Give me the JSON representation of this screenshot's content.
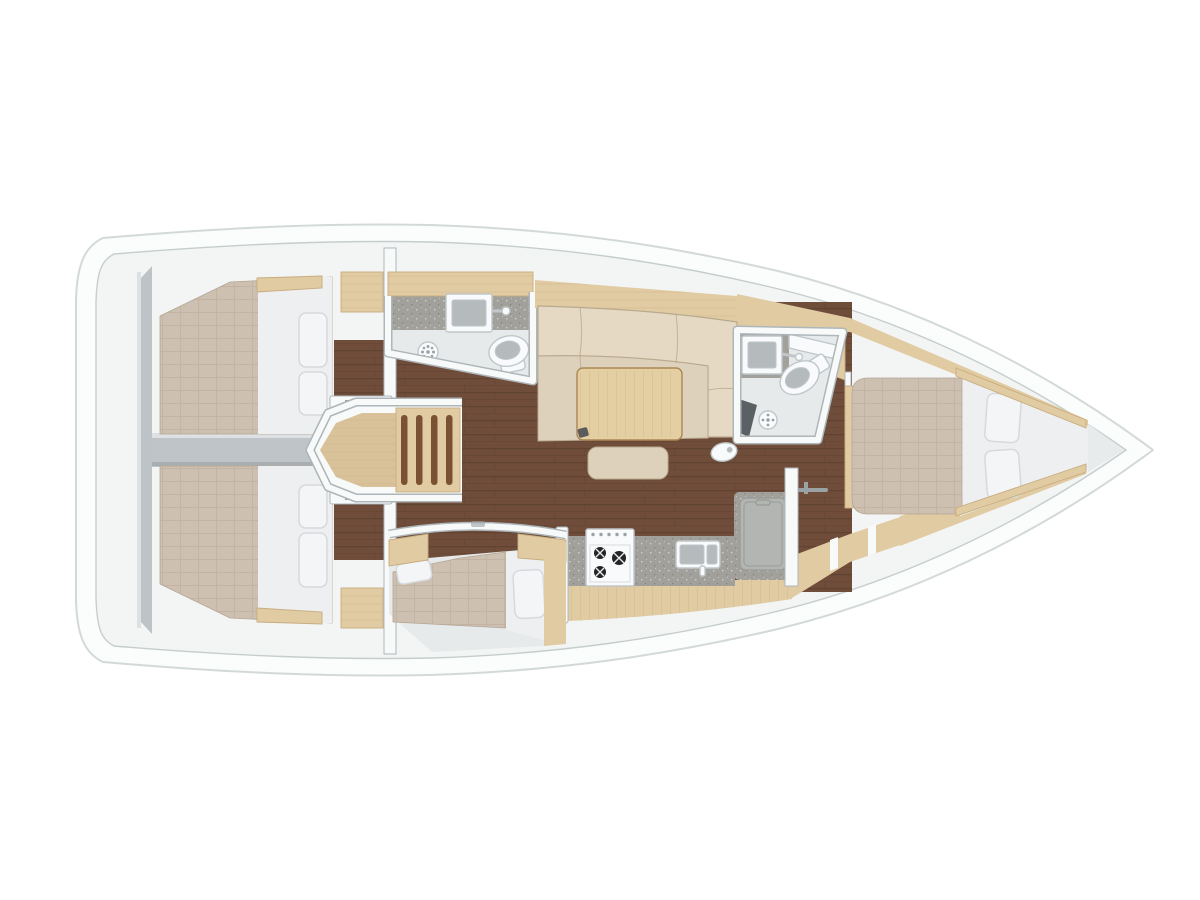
{
  "layout": {
    "title": "Sailing yacht interior layout plan — top-down view, bow to the right",
    "orientation": "bow-right",
    "regions": [
      {
        "id": "aft-cabin-port",
        "label": "aft cabin port: double berth with two pillows"
      },
      {
        "id": "aft-cabin-starboard",
        "label": "aft cabin starboard: double berth with two pillows"
      },
      {
        "id": "stern-structure",
        "label": "stern: transom bulkhead and central divider"
      },
      {
        "id": "companionway-stairs",
        "label": "companionway entry steps"
      },
      {
        "id": "aft-head-port",
        "label": "aft head: sink, toilet, shower drain"
      },
      {
        "id": "salon",
        "label": "salon: L-shaped settee, table, ottoman"
      },
      {
        "id": "galley-starboard",
        "label": "galley: 3-burner stove, double sink, top-loading fridge"
      },
      {
        "id": "forward-head",
        "label": "forward head: sink, toilet, shower drain, seat"
      },
      {
        "id": "forward-cabin",
        "label": "forward cabin: island double berth with two pillows"
      },
      {
        "id": "mid-cabin-starboard",
        "label": "mid cabin starboard: berth with pillows"
      },
      {
        "id": "bow",
        "label": "bow V-section"
      }
    ]
  },
  "colors": {
    "background": "#ffffff",
    "hull_fill": "#fbfcfc",
    "hull_stroke": "#d3d9d9",
    "deck_inner_fill": "#f3f5f5",
    "deck_inner_stroke": "#c6cdcd",
    "wall_fill": "#f8fafa",
    "wall_stroke": "#aeb6ba",
    "gray_structure": "#bdc3c6",
    "divider": "#bec4c7",
    "highlight": "#dde1e3",
    "shadow_gray": "#a8afb2",
    "floor_dark": "#6f4d3a",
    "floor_plank": "#563a2b",
    "wood_light": "#e1cba3",
    "wood_edge": "#c8ac7e",
    "wood_step": "#d9c29a",
    "wood_step_slot": "#7b5134",
    "mattress": "#cec0b1",
    "mattress_line": "#b5a695",
    "bedding_white": "#edeff1",
    "pillow_fill": "#f4f5f7",
    "pillow_stroke": "#d6dadd",
    "sofa_back": "#e5d9c3",
    "sofa_seat": "#ddd1bb",
    "sofa_stroke": "#b9a98e",
    "table_fill": "#e4cfa2",
    "table_stroke": "#ab8756",
    "counter_gray": "#a2a09b",
    "fixture_white": "#f9fafb",
    "fixture_stroke": "#bfc7ca",
    "bath_floor": "#e7eaeb",
    "sink_basin": "#b5bbbd",
    "fridge_lid": "#b3b5b2",
    "fridge_edge": "#979a97",
    "burner_black": "#242526",
    "dark_seat": "#5b6064",
    "handle": "#9aa2a6",
    "v_shade": "#e7ebec"
  }
}
